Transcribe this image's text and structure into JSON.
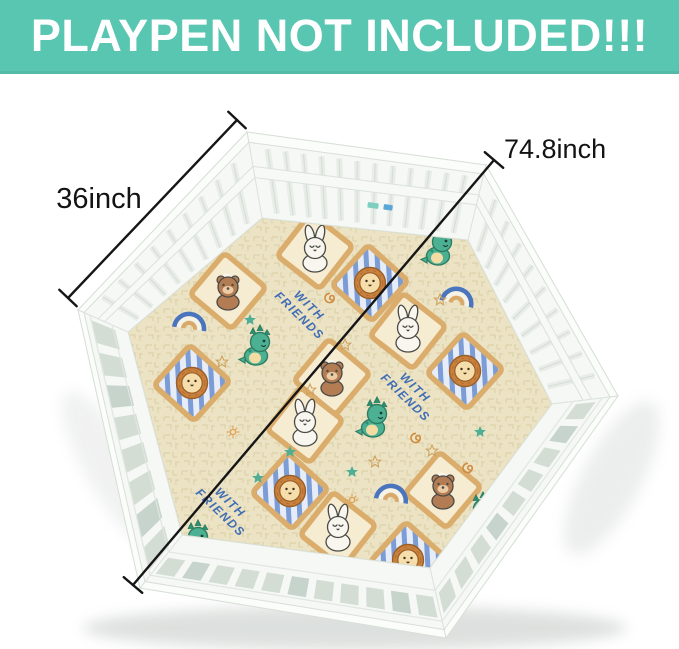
{
  "banner": {
    "text": "PLAYPEN NOT INCLUDED!!!",
    "bg_color": "#58C6B1",
    "text_color": "#FFFFFF"
  },
  "dimensions": {
    "side_panel": {
      "label": "36inch"
    },
    "diagonal": {
      "label": "74.8inch"
    },
    "line_color": "#161616"
  },
  "playpen": {
    "description": "white hexagonal plastic playpen, 6 lattice panels",
    "color": "#F5F8F5"
  },
  "mat": {
    "phrase": "WITH FRIENDS",
    "phrase_words": [
      "WITH",
      "FRIENDS"
    ],
    "phrase_color": "#3F6DB5",
    "background_color": "#EBE3C4",
    "frame_tan_color": "#DBAD6C",
    "frame_blue_stripe_color": "#7B9CD4",
    "motifs": [
      "bunny-icon",
      "bear-icon",
      "lion-icon",
      "dinosaur-icon",
      "rainbow-icon",
      "star-icon",
      "swirl-icon"
    ]
  }
}
